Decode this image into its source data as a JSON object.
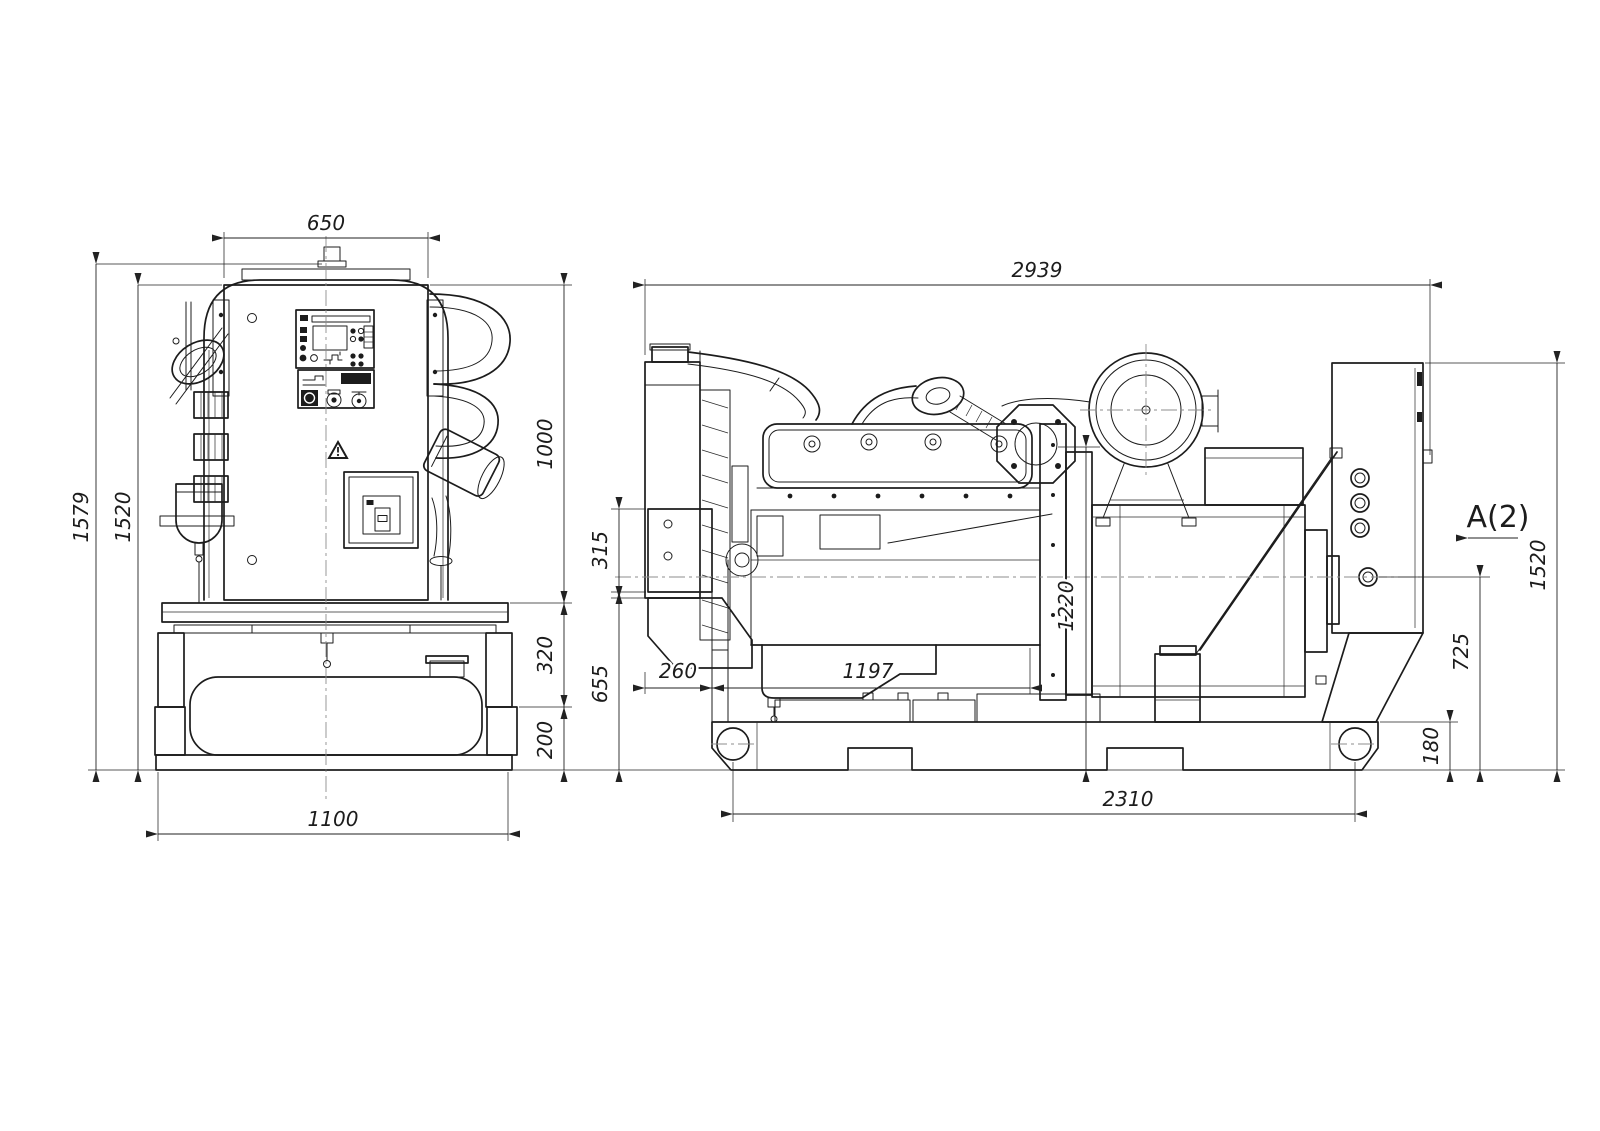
{
  "front_view": {
    "dims": {
      "width_top": "650",
      "height_overall": "1579",
      "height_body": "1520",
      "height_upper": "1000",
      "height_frame": "320",
      "height_base": "200",
      "width_base": "1100"
    }
  },
  "side_view": {
    "view_label": "A(2)",
    "dims": {
      "length_overall": "2939",
      "bracket_height": "315",
      "front_height": "655",
      "front_offset": "260",
      "engine_length": "1197",
      "flywheel_height": "1220",
      "base_length": "2310",
      "rear_height": "1520",
      "axis_height": "725",
      "base_height": "180"
    }
  }
}
